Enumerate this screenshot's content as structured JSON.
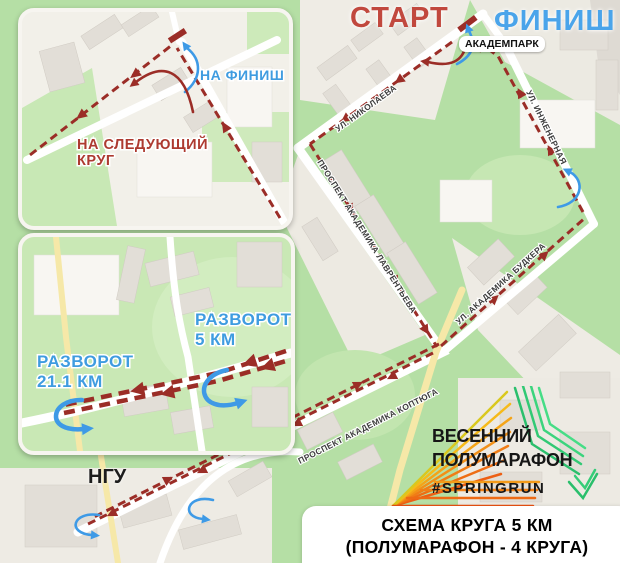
{
  "header": {
    "start": "СТАРТ",
    "finish": "ФИНИШ"
  },
  "map": {
    "poi": {
      "akadempark": "АКАДЕМПАРК",
      "ngu": "НГУ"
    },
    "streets": {
      "nikolaeva": "УЛ. НИКОЛАЕВА",
      "inzhenernaya": "УЛ. ИНЖЕНЕРНАЯ",
      "lavrentieva": "ПРОСПЕКТ АКАДЕМИКА ЛАВРЕНТЬЕВА",
      "budkera": "УЛ. АКАДЕМИКА БУДКЕРА",
      "koptyuga": "ПРОСПЕКТ АКАДЕМИКА КОПТЮГА"
    },
    "colors": {
      "route": "#9b2d27",
      "turn_arrows": "#3e9ae6",
      "start_label": "#c1483e",
      "finish_label": "#4aa4ea",
      "map_green": "#b5dfa5"
    }
  },
  "inset_finish": {
    "to_finish": "НА ФИНИШ",
    "next_lap_line1": "НА СЛЕДУЮЩИЙ",
    "next_lap_line2": "КРУГ"
  },
  "inset_turnarounds": {
    "turn5_line1": "РАЗВОРОТ",
    "turn5_line2": "5 КМ",
    "turn21_line1": "РАЗВОРОТ",
    "turn21_line2": "21.1 КМ"
  },
  "logo": {
    "line1": "ВЕСЕННИЙ",
    "line2": "ПОЛУМАРАФОН",
    "hashtag": "#SPRINGRUN",
    "colors": {
      "orange": "#ee6e15",
      "yellow": "#f4a418",
      "green": "#2abf6c"
    }
  },
  "info_box": {
    "line1": "СХЕМА КРУГА 5 КМ",
    "line2": "(ПОЛУМАРАФОН - 4 КРУГА)"
  }
}
